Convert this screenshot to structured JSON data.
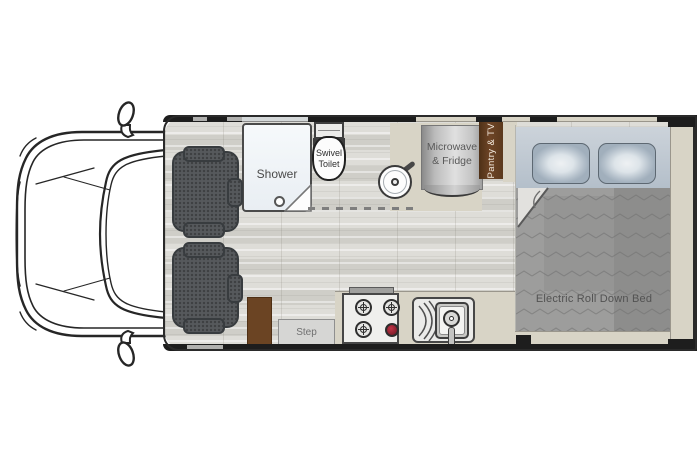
{
  "floorplan": {
    "labels": {
      "shower": "Shower",
      "toilet": "Swivel Toilet",
      "microwave_fridge": "Microwave & Fridge",
      "pantry_tv": "Pantry & TV",
      "step": "Step",
      "bed": "Electric Roll Down Bed"
    },
    "colors": {
      "wall": "#1d1d1d",
      "floor": "#d7d6d0",
      "counter": "#d8d4c6",
      "cabinet_brown": "#6b4423",
      "pantry_brown": "#5e3a1e",
      "chair": "#56595c",
      "bed_head": "#c0c9d3",
      "pillow": "#c6d0d9",
      "blanket": "#9d9d9c",
      "burner_red": "#8d2130",
      "shower": "#f4f8fa"
    },
    "fixtures": [
      "van-cab",
      "captain-chair-front",
      "captain-chair-rear",
      "shower",
      "swivel-toilet",
      "round-sink",
      "microwave-fridge-cabinet",
      "pantry-tv-cabinet",
      "electric-roll-down-bed",
      "pillows",
      "stove",
      "kitchen-sink",
      "entry-step",
      "storage-cabinet"
    ]
  }
}
